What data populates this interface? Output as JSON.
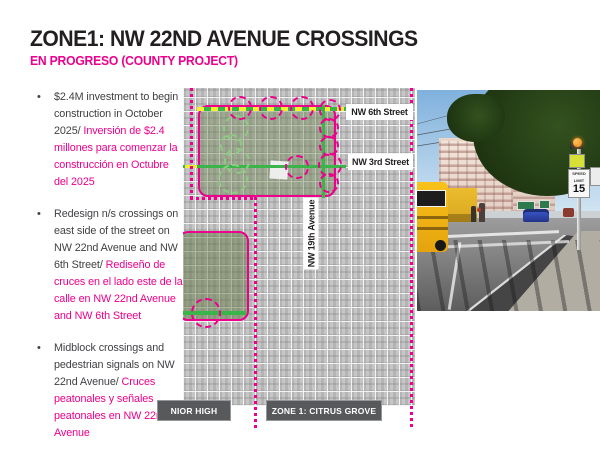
{
  "slide": {
    "title": "ZONE1: NW 22ND AVENUE CROSSINGS",
    "subtitle": "EN PROGRESO (COUNTY PROJECT)"
  },
  "bullets": [
    {
      "en": "$2.4M investment to begin construction in October 2025/ ",
      "es": "Inversión de $2.4 millones para comenzar la construcción en Octubre del 2025"
    },
    {
      "en": "Redesign n/s crossings on east side of the street on NW 22nd Avenue and NW 6th Street/ ",
      "es": "Rediseño de cruces en el lado este de la calle en NW 22nd Avenue and NW 6th Street"
    },
    {
      "en": "Midblock crossings and pedestrian signals on NW 22nd Avenue/ ",
      "es": "Cruces peatonales y señales peatonales en NW 22nd Avenue"
    }
  ],
  "map": {
    "street_labels": {
      "nw6": "NW 6th Street",
      "nw3": "NW 3rd Street",
      "nw19": "NW 19th Avenue"
    },
    "area_labels": {
      "junior_high": "NIOR HIGH",
      "zone1": "ZONE 1: CITRUS GROVE"
    }
  },
  "photo": {
    "speed_sign": {
      "line1": "SPEED",
      "line2": "LIMIT",
      "value": "15"
    }
  },
  "colors": {
    "magenta": "#ec008c",
    "street_green": "#39b54a",
    "circle_green": "#8fca85",
    "dash_yellow": "#f9ed32",
    "label_gray": "#58595b"
  }
}
